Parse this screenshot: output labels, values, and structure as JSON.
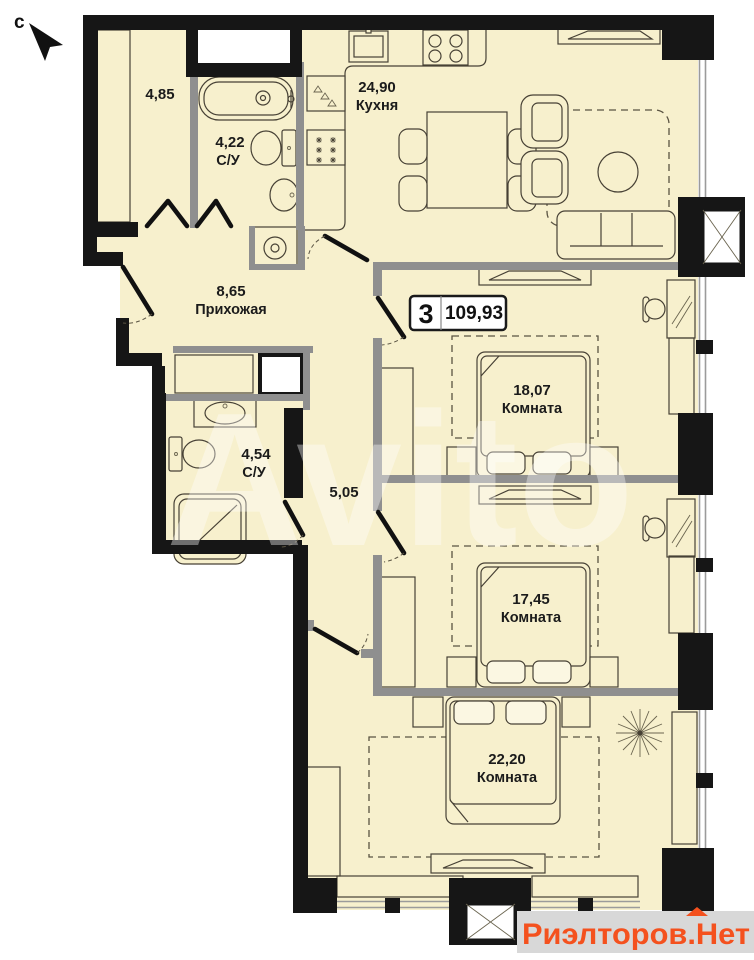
{
  "compass": {
    "label": "с"
  },
  "badge": {
    "rooms_count": "3",
    "total_area": "109,93"
  },
  "rooms": {
    "storage": {
      "area": "4,85",
      "name": ""
    },
    "bath_top": {
      "area": "4,22",
      "name": "С/У"
    },
    "kitchen": {
      "area": "24,90",
      "name": "Кухня"
    },
    "hallway": {
      "area": "8,65",
      "name": "Прихожая"
    },
    "bedroom1": {
      "area": "18,07",
      "name": "Комната"
    },
    "bath_mid": {
      "area": "4,54",
      "name": "С/У"
    },
    "corridor": {
      "area": "5,05",
      "name": ""
    },
    "bedroom2": {
      "area": "17,45",
      "name": "Комната"
    },
    "bedroom3": {
      "area": "22,20",
      "name": "Комната"
    }
  },
  "watermarks": {
    "center": "Avito",
    "bottom_right": "Риэлторов.Нет"
  },
  "colors": {
    "floor": "#f7f0cd",
    "wall": "#161616",
    "partition": "#8f8f8f",
    "accent": "#f4511e",
    "watermark_bg": "#d8d8d8",
    "badge_bg": "#ffffff"
  }
}
